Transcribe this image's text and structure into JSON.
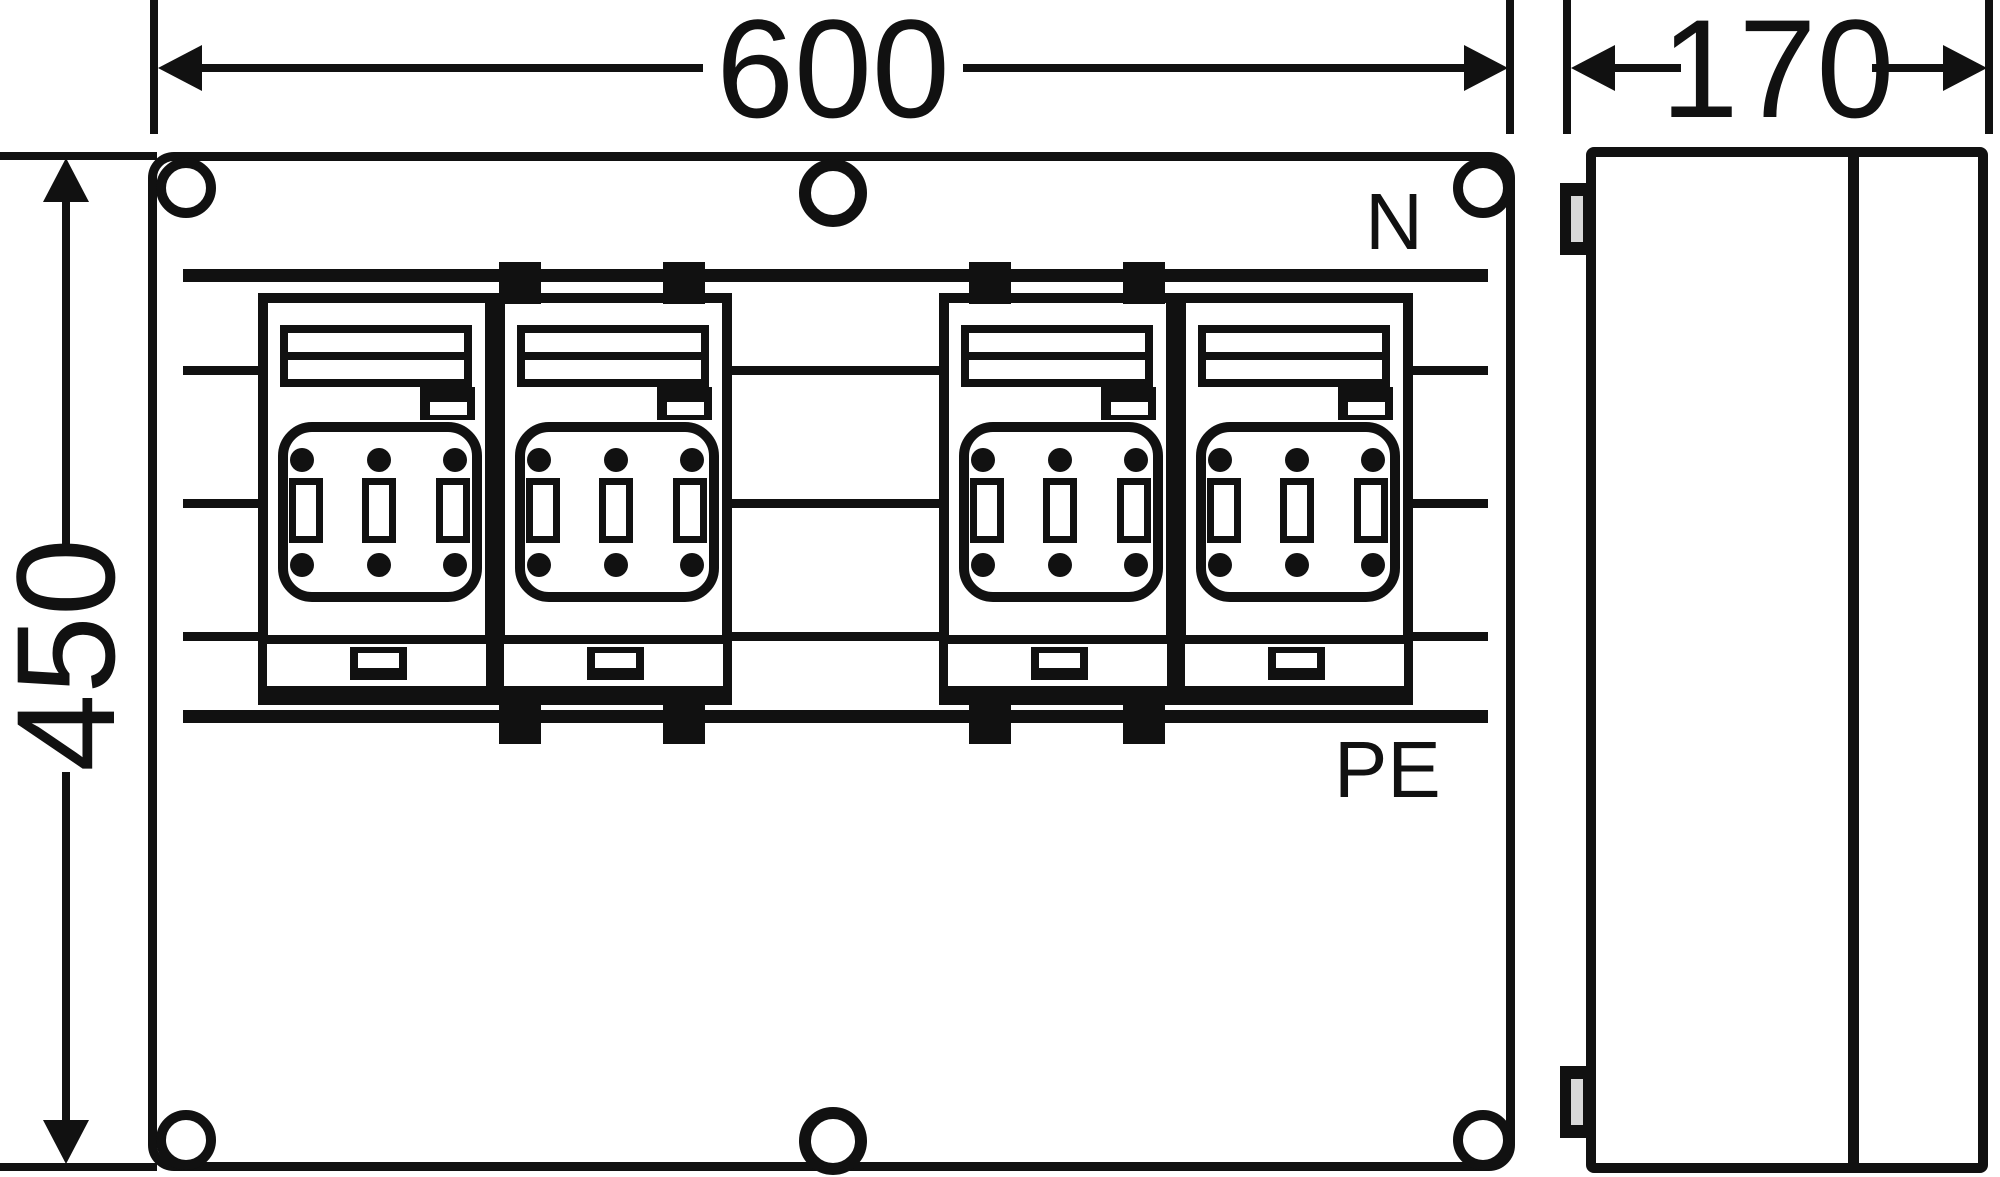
{
  "dimensions": {
    "width_label": "600",
    "height_label": "450",
    "depth_label": "170"
  },
  "labels": {
    "neutral_busbar": "N",
    "pe_busbar": "PE"
  },
  "colors": {
    "ink": "#111111",
    "paper": "#ffffff",
    "slot_gray": "#d9d9d9"
  }
}
